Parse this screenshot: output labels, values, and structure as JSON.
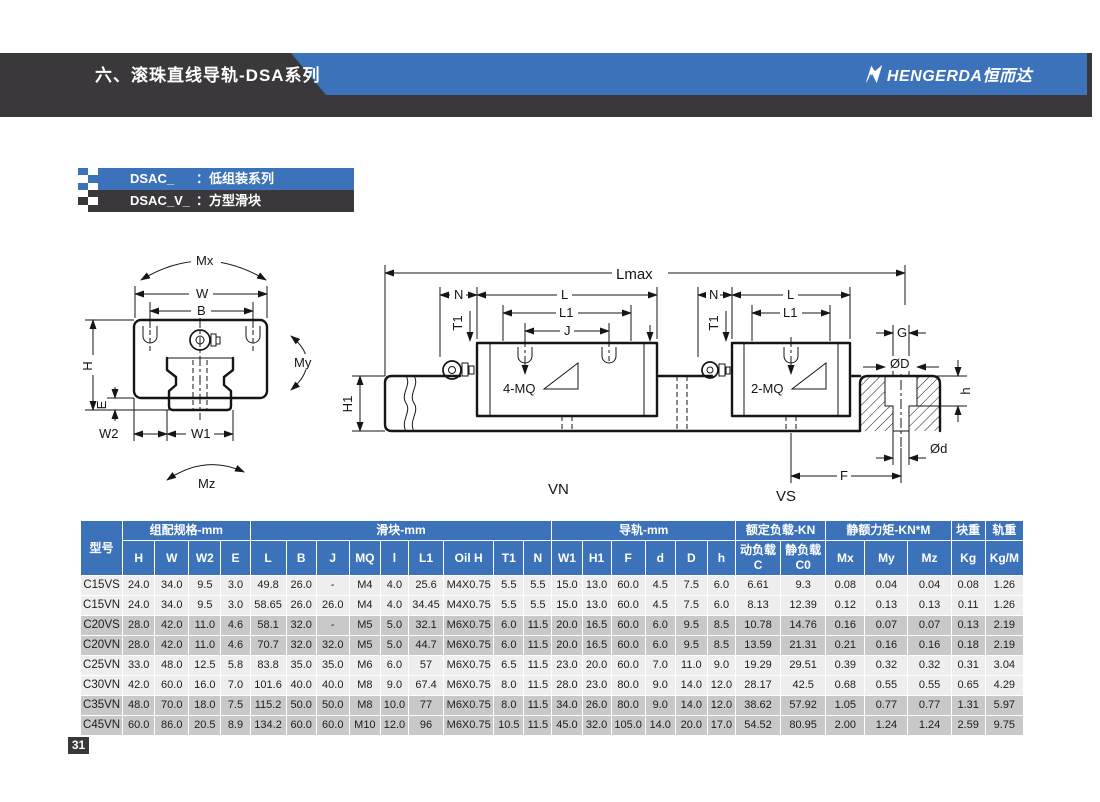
{
  "theme": {
    "accent_blue": "#3B72B9",
    "band_dark": "#3A383A",
    "row_light": "#EFEEEE",
    "row_shaded": "#C9C8C8"
  },
  "header": {
    "title": "六、滚珠直线导轨-DSA系列",
    "brand_text": "HENGERDA恒而达"
  },
  "series_labels": [
    {
      "code": "DSAC_",
      "separator": "：",
      "desc": "低组装系列"
    },
    {
      "code": "DSAC_V_",
      "separator": "：",
      "desc": "方型滑块"
    }
  ],
  "diagram": {
    "labels": {
      "mx": "Mx",
      "w": "W",
      "b": "B",
      "h": "H",
      "e": "E",
      "my": "My",
      "w2": "W2",
      "w1": "W1",
      "mz": "Mz",
      "lmax": "Lmax",
      "n1": "N",
      "l_vn": "L",
      "l1_vn": "L1",
      "j": "J",
      "t1_vn": "T1",
      "mq4": "4-MQ",
      "h1": "H1",
      "n2": "N",
      "t1_vs": "T1",
      "l_vs": "L",
      "l1_vs": "L1",
      "mq2": "2-MQ",
      "g": "G",
      "phi_d_big": "ØD",
      "h_small": "h",
      "phi_d_small": "Ød",
      "f": "F",
      "vn": "VN",
      "vs": "VS"
    }
  },
  "table": {
    "model_header": "型号",
    "groups": [
      {
        "label": "组配规格-mm",
        "span": 4
      },
      {
        "label": "滑块-mm",
        "span": 9
      },
      {
        "label": "导轨-mm",
        "span": 6
      },
      {
        "label": "额定负载-KN",
        "span": 2
      },
      {
        "label": "静额力矩-KN*M",
        "span": 3
      },
      {
        "label": "块重",
        "span": 1
      },
      {
        "label": "轨重",
        "span": 1
      }
    ],
    "columns": [
      "H",
      "W",
      "W2",
      "E",
      "L",
      "B",
      "J",
      "MQ",
      "l",
      "L1",
      "Oil H",
      "T1",
      "N",
      "W1",
      "H1",
      "F",
      "d",
      "D",
      "h",
      "动负载C",
      "静负载C0",
      "Mx",
      "My",
      "Mz",
      "Kg",
      "Kg/M"
    ],
    "rows": [
      {
        "model": "C15VS",
        "values": [
          "24.0",
          "34.0",
          "9.5",
          "3.0",
          "49.8",
          "26.0",
          "-",
          "M4",
          "4.0",
          "25.6",
          "M4X0.75",
          "5.5",
          "5.5",
          "15.0",
          "13.0",
          "60.0",
          "4.5",
          "7.5",
          "6.0",
          "6.61",
          "9.3",
          "0.08",
          "0.04",
          "0.04",
          "0.08",
          "1.26"
        ]
      },
      {
        "model": "C15VN",
        "values": [
          "24.0",
          "34.0",
          "9.5",
          "3.0",
          "58.65",
          "26.0",
          "26.0",
          "M4",
          "4.0",
          "34.45",
          "M4X0.75",
          "5.5",
          "5.5",
          "15.0",
          "13.0",
          "60.0",
          "4.5",
          "7.5",
          "6.0",
          "8.13",
          "12.39",
          "0.12",
          "0.13",
          "0.13",
          "0.11",
          "1.26"
        ]
      },
      {
        "model": "C20VS",
        "values": [
          "28.0",
          "42.0",
          "11.0",
          "4.6",
          "58.1",
          "32.0",
          "-",
          "M5",
          "5.0",
          "32.1",
          "M6X0.75",
          "6.0",
          "11.5",
          "20.0",
          "16.5",
          "60.0",
          "6.0",
          "9.5",
          "8.5",
          "10.78",
          "14.76",
          "0.16",
          "0.07",
          "0.07",
          "0.13",
          "2.19"
        ]
      },
      {
        "model": "C20VN",
        "values": [
          "28.0",
          "42.0",
          "11.0",
          "4.6",
          "70.7",
          "32.0",
          "32.0",
          "M5",
          "5.0",
          "44.7",
          "M6X0.75",
          "6.0",
          "11.5",
          "20.0",
          "16.5",
          "60.0",
          "6.0",
          "9.5",
          "8.5",
          "13.59",
          "21.31",
          "0.21",
          "0.16",
          "0.16",
          "0.18",
          "2.19"
        ]
      },
      {
        "model": "C25VN",
        "values": [
          "33.0",
          "48.0",
          "12.5",
          "5.8",
          "83.8",
          "35.0",
          "35.0",
          "M6",
          "6.0",
          "57",
          "M6X0.75",
          "6.5",
          "11.5",
          "23.0",
          "20.0",
          "60.0",
          "7.0",
          "11.0",
          "9.0",
          "19.29",
          "29.51",
          "0.39",
          "0.32",
          "0.32",
          "0.31",
          "3.04"
        ]
      },
      {
        "model": "C30VN",
        "values": [
          "42.0",
          "60.0",
          "16.0",
          "7.0",
          "101.6",
          "40.0",
          "40.0",
          "M8",
          "9.0",
          "67.4",
          "M6X0.75",
          "8.0",
          "11.5",
          "28.0",
          "23.0",
          "80.0",
          "9.0",
          "14.0",
          "12.0",
          "28.17",
          "42.5",
          "0.68",
          "0.55",
          "0.55",
          "0.65",
          "4.29"
        ]
      },
      {
        "model": "C35VN",
        "values": [
          "48.0",
          "70.0",
          "18.0",
          "7.5",
          "115.2",
          "50.0",
          "50.0",
          "M8",
          "10.0",
          "77",
          "M6X0.75",
          "8.0",
          "11.5",
          "34.0",
          "26.0",
          "80.0",
          "9.0",
          "14.0",
          "12.0",
          "38.62",
          "57.92",
          "1.05",
          "0.77",
          "0.77",
          "1.31",
          "5.97"
        ]
      },
      {
        "model": "C45VN",
        "values": [
          "60.0",
          "86.0",
          "20.5",
          "8.9",
          "134.2",
          "60.0",
          "60.0",
          "M10",
          "12.0",
          "96",
          "M6X0.75",
          "10.5",
          "11.5",
          "45.0",
          "32.0",
          "105.0",
          "14.0",
          "20.0",
          "17.0",
          "54.52",
          "80.95",
          "2.00",
          "1.24",
          "1.24",
          "2.59",
          "9.75"
        ]
      }
    ]
  },
  "footer": {
    "page_number": "31"
  }
}
